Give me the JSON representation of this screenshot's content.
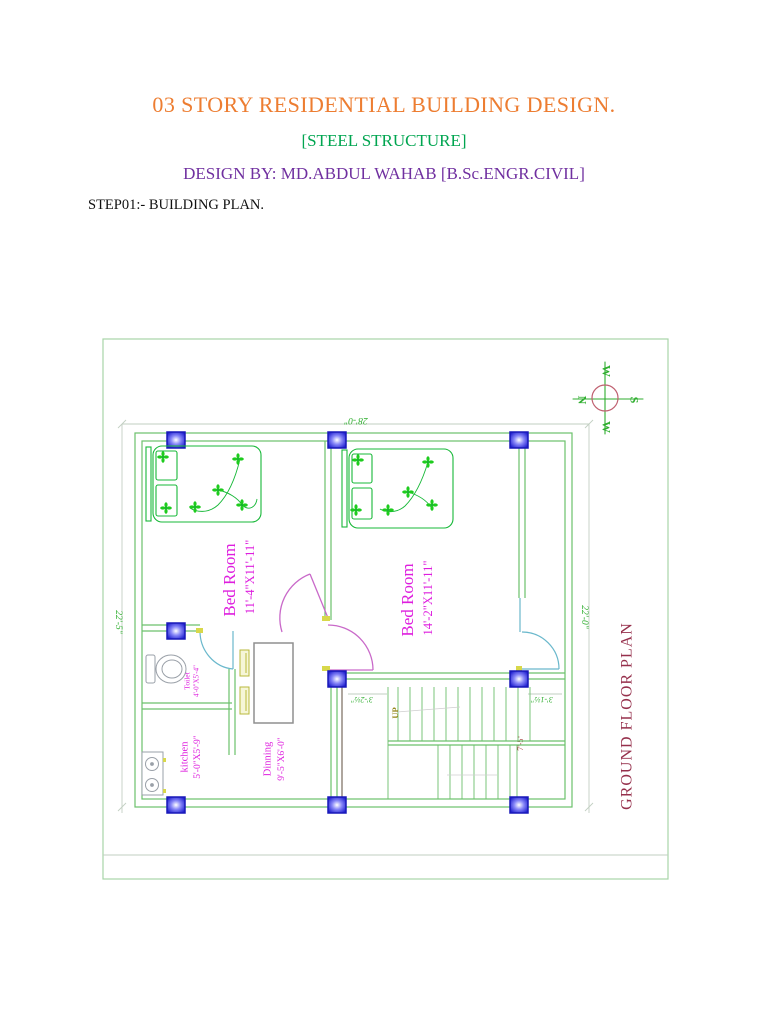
{
  "header": {
    "title": "03 STORY RESIDENTIAL BUILDING DESIGN.",
    "subtitle": "[STEEL STRUCTURE]",
    "design_by": "DESIGN BY: MD.ABDUL WAHAB [B.Sc.ENGR.CIVIL]",
    "step": "STEP01:- BUILDING PLAN."
  },
  "plan": {
    "title": "GROUND FLOOR PLAN",
    "compass": {
      "north": "N",
      "south": "S",
      "west_top": "W",
      "west_bottom": "W"
    },
    "dimensions": {
      "top": "28'-0\"",
      "left": "22'-5\"",
      "right": "22'-0\"",
      "stair_left": "3'-2½\"",
      "stair_right": "3'-1½\"",
      "stair_height": "7'-5\""
    },
    "rooms": {
      "bedroom1": {
        "label": "Bed Room",
        "size": "11'-4\"X11'-11\""
      },
      "bedroom2": {
        "label": "Bed Room",
        "size": "14'-2\"X11'-11\""
      },
      "toilet": {
        "label": "Toilet",
        "size": "4'-0\"X5'-4\""
      },
      "kitchen": {
        "label": "kitchen",
        "size": "5'-0\"X5'-9\""
      },
      "dining": {
        "label": "Dinning",
        "size": "9'-5\"X6'-0\""
      }
    },
    "stairs": {
      "up_label": "UP"
    }
  },
  "colors": {
    "title_orange": "#ED7D31",
    "steel_green": "#00A550",
    "design_purple": "#7030A0",
    "wall_green": "#6CC06C",
    "furniture_green": "#17B838",
    "flower_green": "#1ECC1E",
    "label_magenta": "#DE1EDE",
    "dim_green": "#2FAE2F",
    "plan_title_maroon": "#96304C",
    "door_magenta": "#C969C9",
    "door_cyan": "#6AB8CC",
    "column_blue": "#1818B8",
    "up_olive": "#948618",
    "stair_dim_red": "#A23434"
  }
}
